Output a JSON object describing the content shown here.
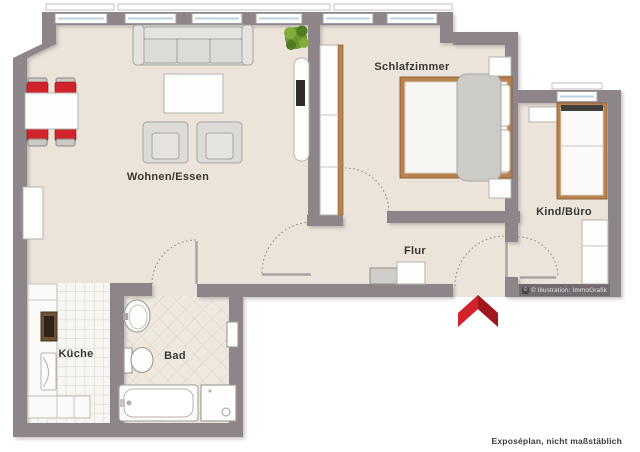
{
  "title": "Exposéplan Wohnung",
  "labels": {
    "living": "Wohnen/Essen",
    "bedroom": "Schlafzimmer",
    "kids_office": "Kind/Büro",
    "hallway": "Flur",
    "kitchen": "Küche",
    "bath": "Bad"
  },
  "watermark": {
    "badge": "©",
    "text": "© Illustration: ImmoGrafik"
  },
  "footer": {
    "note": "Exposéplan, nicht maßstäblich"
  },
  "entrance": {
    "marker": "red-entrance-arrow"
  },
  "furniture": {
    "living": [
      "sofa",
      "coffee-table",
      "armchair",
      "armchair",
      "dining-table",
      "dining-chairs-red",
      "sideboard",
      "tv-board",
      "plant"
    ],
    "bedroom": [
      "double-bed",
      "wardrobe",
      "nightstand",
      "nightstand"
    ],
    "kids_office": [
      "single-bed",
      "shelf",
      "desk-cabinet"
    ],
    "hallway": [
      "shoe-cabinet",
      "dresser"
    ],
    "kitchen": [
      "counter",
      "stove",
      "kitchen-appliance"
    ],
    "bath": [
      "wash-basin",
      "toilet",
      "bathtub",
      "washing-machine",
      "radiator"
    ]
  },
  "colors": {
    "wall": "#8e858b",
    "floor": "#ece4db",
    "kitchen_tile": "#f8f6f2",
    "bath_tile": "#eee8df",
    "tile_line": "#d8d2c8",
    "furn": "#dcdbd8",
    "furn_stroke": "#a6a5a1",
    "wood": "#b9824f",
    "wood_dark": "#8f6137",
    "accent_red": "#d2232b",
    "accent_red_dark": "#9f181d",
    "plant_green": "#679733",
    "label_text": "#3a3733"
  }
}
